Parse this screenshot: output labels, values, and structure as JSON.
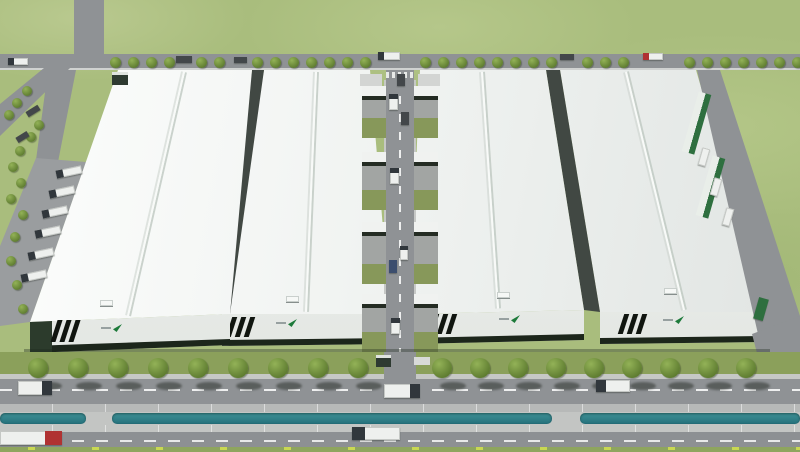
{
  "meta": {
    "type": "aerial-architectural-rendering",
    "description": "Bird's-eye 3D rendering of a logistics industrial park: four long white-roofed warehouse buildings with black facade stripes and green company logos, a central service road with loading docks and lawns, perimeter roads lined with trees and trucks, a teal drainage canal between two parallel front roads, all surrounded by green grass.",
    "canvas": {
      "w": 800,
      "h": 452
    }
  },
  "palette": {
    "grass": "#a9bd7d",
    "road": "#8f9295",
    "parking": "#9a9d9f",
    "apron": "#a2a5a3",
    "sidewalk": "#c6c8c6",
    "median": "#b7b9b8",
    "bank": "#c3c5c3",
    "road2": "#8d9093",
    "canalTop": "#3f9196",
    "canalBottom": "#25707b",
    "lawn": "#8ba05b",
    "dockLawn": "#87985a",
    "greenStrip": "#8ea55e",
    "roofLight": "#fdfefd",
    "roofShade": "#e0e4e2",
    "facadeTop": "#f4f6f3",
    "facadeBottom": "#dfe3df",
    "facadeBase": "#1c261b",
    "endcap": "#2c3b2c",
    "wall": "#414843",
    "stripe": "#10150f",
    "logoGreen": "#1d7a3a",
    "logoText": "#97a0a0",
    "treeLight": "#93b257",
    "treeDark": "#5e7c30",
    "shadow": "rgba(35,42,35,0.5)",
    "truckWhite": "#eef0ee",
    "truckDark": "#43474a",
    "cabDefault": "#31373c",
    "cabRed": "#b03232",
    "container": "#2e6f3f",
    "booth": "#2e3a31",
    "marker": "#c9d852"
  },
  "buildings": [
    {
      "id": "warehouse-4",
      "roof": [
        [
          560,
          70
        ],
        [
          696,
          70
        ],
        [
          766,
          312
        ],
        [
          600,
          312
        ]
      ],
      "ridge": [
        626,
        72,
        684,
        310
      ],
      "facade": [
        [
          600,
          312
        ],
        [
          766,
          312
        ],
        [
          766,
          342
        ],
        [
          600,
          344
        ]
      ],
      "base": [
        [
          600,
          338
        ],
        [
          766,
          336
        ],
        [
          766,
          342
        ],
        [
          600,
          344
        ]
      ],
      "stripes": [
        621,
        314,
        20
      ],
      "logo": [
        663,
        316
      ],
      "vent": [
        664,
        288
      ],
      "wall": [
        [
          546,
          70
        ],
        [
          560,
          70
        ],
        [
          600,
          312
        ],
        [
          584,
          310
        ]
      ]
    },
    {
      "id": "warehouse-3",
      "roof": [
        [
          420,
          70
        ],
        [
          546,
          70
        ],
        [
          584,
          310
        ],
        [
          410,
          314
        ]
      ],
      "ridge": [
        482,
        72,
        498,
        308
      ],
      "facade": [
        [
          410,
          314
        ],
        [
          584,
          310
        ],
        [
          584,
          340
        ],
        [
          410,
          344
        ]
      ],
      "base": [
        [
          410,
          338
        ],
        [
          584,
          334
        ],
        [
          584,
          340
        ],
        [
          410,
          344
        ]
      ],
      "stripes": [
        431,
        314,
        20
      ],
      "logo": [
        499,
        315
      ],
      "vent": [
        497,
        292
      ]
    },
    {
      "id": "warehouse-2",
      "roof": [
        [
          264,
          70
        ],
        [
          370,
          70
        ],
        [
          390,
          314
        ],
        [
          222,
          314
        ]
      ],
      "ridge": [
        316,
        72,
        306,
        312
      ],
      "facade": [
        [
          222,
          314
        ],
        [
          390,
          314
        ],
        [
          390,
          344
        ],
        [
          222,
          346
        ]
      ],
      "base": [
        [
          222,
          340
        ],
        [
          390,
          338
        ],
        [
          390,
          344
        ],
        [
          222,
          346
        ]
      ],
      "stripes": [
        229,
        317,
        20
      ],
      "logo": [
        276,
        319
      ],
      "vent": [
        286,
        296
      ],
      "wall": [
        [
          252,
          70
        ],
        [
          264,
          70
        ],
        [
          230,
          314
        ],
        [
          223,
          314
        ]
      ]
    },
    {
      "id": "warehouse-1",
      "roof": [
        [
          118,
          70
        ],
        [
          252,
          70
        ],
        [
          230,
          314
        ],
        [
          30,
          322
        ]
      ],
      "ridge": [
        184,
        72,
        128,
        316
      ],
      "facade": [
        [
          30,
          322
        ],
        [
          230,
          314
        ],
        [
          230,
          345
        ],
        [
          30,
          353
        ]
      ],
      "base": [
        [
          30,
          346
        ],
        [
          230,
          339
        ],
        [
          230,
          345
        ],
        [
          30,
          353
        ]
      ],
      "endcap": [
        [
          30,
          322
        ],
        [
          52,
          321
        ],
        [
          52,
          352
        ],
        [
          30,
          353
        ]
      ],
      "stripes": [
        54,
        320,
        22
      ],
      "logo": [
        101,
        324
      ],
      "vent": [
        100,
        300
      ]
    }
  ],
  "topRoad": {
    "x": 0,
    "y": 54,
    "w": 800,
    "h": 16,
    "treeY": 57,
    "treeXs": [
      110,
      128,
      146,
      164,
      196,
      214,
      252,
      270,
      288,
      306,
      324,
      342,
      360,
      420,
      438,
      456,
      474,
      492,
      510,
      528,
      546,
      582,
      600,
      618,
      684,
      702,
      720,
      738,
      756,
      774,
      792
    ]
  },
  "leftArea": {
    "verticalRoad": [
      74,
      0,
      30,
      58
    ],
    "diagonal": [
      [
        0,
        104
      ],
      [
        44,
        68
      ],
      [
        70,
        68
      ],
      [
        0,
        136
      ]
    ],
    "branch": [
      [
        48,
        70
      ],
      [
        76,
        70
      ],
      [
        58,
        162
      ],
      [
        36,
        160
      ]
    ],
    "parking": [
      [
        36,
        158
      ],
      [
        86,
        162
      ],
      [
        30,
        322
      ],
      [
        0,
        326
      ],
      [
        0,
        246
      ]
    ],
    "trees": [
      [
        22,
        86
      ],
      [
        12,
        98
      ],
      [
        4,
        110
      ],
      [
        34,
        120
      ],
      [
        26,
        132
      ],
      [
        15,
        146
      ],
      [
        8,
        162
      ],
      [
        16,
        178
      ],
      [
        6,
        194
      ],
      [
        18,
        210
      ],
      [
        10,
        232
      ],
      [
        6,
        256
      ],
      [
        12,
        280
      ],
      [
        18,
        304
      ]
    ]
  },
  "centralRoad": {
    "road": [
      386,
      70,
      28,
      310
    ],
    "dash": [
      399,
      78,
      2,
      296
    ],
    "edges": [
      [
        384,
        80,
        2,
        272
      ],
      [
        414,
        80,
        2,
        272
      ]
    ],
    "crosswalk": [
      386,
      72,
      28,
      6
    ],
    "pads": [
      [
        360,
        74,
        22,
        12
      ],
      [
        418,
        74,
        22,
        12
      ]
    ],
    "apronXs": [
      362,
      414
    ],
    "apronW": 24,
    "segments": [
      [
        86,
        52
      ],
      [
        152,
        58
      ],
      [
        222,
        62
      ],
      [
        294,
        58
      ]
    ],
    "exit": [
      384,
      352,
      32,
      28
    ]
  },
  "rightRoad": {
    "poly": [
      [
        697,
        70
      ],
      [
        720,
        70
      ],
      [
        800,
        316
      ],
      [
        800,
        352
      ],
      [
        758,
        334
      ]
    ],
    "exit": [
      [
        752,
        334
      ],
      [
        800,
        316
      ],
      [
        800,
        380
      ],
      [
        764,
        380
      ]
    ],
    "containers": [
      [
        690,
        92,
        13,
        62
      ],
      [
        704,
        156,
        13,
        62
      ]
    ],
    "rot": 16
  },
  "frontBand": {
    "shadowStrip": [
      24,
      349,
      746,
      5
    ],
    "lawn": [
      0,
      352,
      800,
      22
    ],
    "sidewalk": [
      0,
      374,
      800,
      5
    ],
    "road": [
      0,
      379,
      800,
      25
    ],
    "roadDash": [
      0,
      389,
      800,
      2
    ],
    "median": [
      0,
      404,
      800,
      8
    ],
    "canalBand": [
      0,
      412,
      800,
      13
    ],
    "canalSegs": [
      [
        0,
        86
      ],
      [
        112,
        440
      ],
      [
        580,
        220
      ]
    ],
    "bank": [
      0,
      425,
      800,
      9
    ],
    "road2": [
      0,
      432,
      800,
      15
    ],
    "road2Dash": [
      0,
      440,
      800,
      2
    ],
    "greenStrip": [
      0,
      447,
      800,
      5
    ],
    "markerXs": [
      28,
      92,
      156,
      220,
      284,
      348,
      412,
      476,
      540,
      604,
      668,
      732,
      796
    ],
    "markerY": 447
  },
  "frontTrees": {
    "y": 358,
    "xs": [
      28,
      68,
      108,
      148,
      188,
      228,
      268,
      308,
      348,
      432,
      470,
      508,
      546,
      584,
      622,
      660,
      698,
      736
    ],
    "shadowY": 382,
    "shadowDx": 8
  },
  "booths": [
    [
      112,
      72,
      16,
      13
    ],
    [
      376,
      355,
      15,
      12
    ]
  ],
  "whitePad": [
    414,
    357,
    16,
    8
  ],
  "trucks": [
    [
      8,
      58,
      20,
      7,
      0,
      "w",
      "left",
      ""
    ],
    [
      176,
      56,
      16,
      7,
      0,
      "d",
      "",
      ""
    ],
    [
      234,
      57,
      13,
      6,
      0,
      "d",
      "",
      ""
    ],
    [
      378,
      52,
      22,
      8,
      0,
      "w",
      "left",
      ""
    ],
    [
      560,
      54,
      14,
      6,
      0,
      "d",
      "",
      ""
    ],
    [
      643,
      53,
      20,
      7,
      0,
      "w",
      "left",
      "#b03232"
    ],
    [
      26,
      108,
      14,
      6,
      -32,
      "d",
      "",
      ""
    ],
    [
      16,
      134,
      13,
      6,
      -32,
      "d",
      "",
      ""
    ],
    [
      56,
      168,
      26,
      8,
      -12,
      "w",
      "left",
      ""
    ],
    [
      49,
      188,
      26,
      8,
      -12,
      "w",
      "left",
      ""
    ],
    [
      42,
      208,
      26,
      8,
      -12,
      "w",
      "left",
      ""
    ],
    [
      35,
      228,
      26,
      8,
      -12,
      "w",
      "left",
      ""
    ],
    [
      28,
      250,
      26,
      8,
      -12,
      "w",
      "left",
      ""
    ],
    [
      21,
      272,
      26,
      8,
      -12,
      "w",
      "left",
      ""
    ],
    [
      389,
      94,
      9,
      16,
      0,
      "w",
      "top",
      ""
    ],
    [
      401,
      112,
      8,
      13,
      0,
      "d",
      "",
      ""
    ],
    [
      390,
      168,
      9,
      16,
      0,
      "w",
      "top",
      ""
    ],
    [
      400,
      246,
      8,
      14,
      0,
      "w",
      "top",
      ""
    ],
    [
      389,
      260,
      8,
      13,
      0,
      "#3c4e6e",
      "",
      ""
    ],
    [
      391,
      318,
      9,
      16,
      0,
      "w",
      "top",
      ""
    ],
    [
      397,
      74,
      8,
      12,
      0,
      "d",
      "",
      ""
    ],
    [
      700,
      148,
      8,
      18,
      16,
      "w",
      "",
      ""
    ],
    [
      712,
      178,
      8,
      18,
      16,
      "w",
      "",
      ""
    ],
    [
      724,
      208,
      8,
      18,
      16,
      "w",
      "",
      ""
    ],
    [
      756,
      298,
      10,
      22,
      16,
      "#2e6f3f",
      "",
      ""
    ],
    [
      18,
      381,
      34,
      14,
      0,
      "w",
      "right",
      ""
    ],
    [
      384,
      384,
      36,
      14,
      0,
      "w",
      "right",
      ""
    ],
    [
      596,
      380,
      34,
      12,
      0,
      "w",
      "left",
      ""
    ],
    [
      0,
      431,
      62,
      14,
      0,
      "w",
      "right",
      "#b03232"
    ],
    [
      352,
      427,
      48,
      13,
      0,
      "w",
      "left",
      ""
    ]
  ]
}
